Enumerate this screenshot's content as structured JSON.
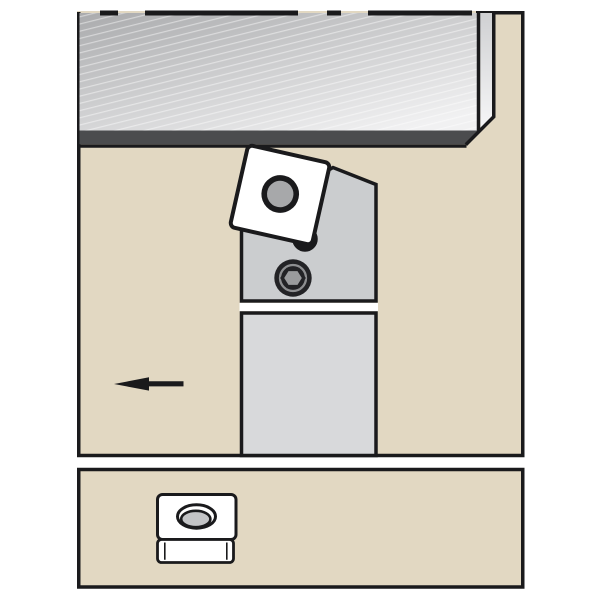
{
  "scene": {
    "title": "Turning toolholder application illustration",
    "description": "Side-view diagram of a lathe toolholder with a square indexable insert cutting a shaded workpiece, feed direction arrow pointing left; lower panel shows the insert shape with its center hole.",
    "main_panel": {
      "name": "machining-operation-view",
      "elements": [
        "workpiece-with-diagonal-hatching",
        "depth-of-cut-dark-band",
        "square-insert-with-center-hole",
        "toolholder-head",
        "clamp-pin-ring",
        "hex-socket-screw",
        "toolholder-shank",
        "feed-direction-arrow-left"
      ]
    },
    "bottom_panel": {
      "name": "insert-shape-key",
      "elements": [
        "insert-top-face-with-oval-hole",
        "insert-side-face"
      ]
    }
  },
  "icons": [
    {
      "name": "feed-direction-arrow",
      "glyph": "←",
      "meaning": "tool feed direction (left)"
    },
    {
      "name": "hex-socket-screw-icon",
      "meaning": "clamping screw with hexagon socket"
    },
    {
      "name": "insert-shape-icon",
      "meaning": "square insert with round center hole"
    }
  ],
  "colors": {
    "background": "#ffffff",
    "panel_fill": "#e2d8c2",
    "outline": "#1a1a1c",
    "stripe_fill": "#ffffff",
    "wp_grad_top": "#aaabad",
    "wp_grad_bottom": "#f1f1f2",
    "strip_grad_top": "#cfd0d2",
    "strip_grad_bottom": "#f7f7f8",
    "wp_band": "#4b4c4e",
    "hatch_line": "rgba(255,255,255,0.45)",
    "holder_head": "#cbcdcf",
    "holder_shank": "#d8d9db",
    "insert_fill": "#ffffff",
    "insert_hole": "#a7a8aa",
    "pin_inner": "#c6c7c9",
    "screw_dark": "#232326",
    "screw_ring": "#8e8f91",
    "hex_fill": "#9a9b9d",
    "icon_ellipse_inner": "#c3c4c6"
  }
}
